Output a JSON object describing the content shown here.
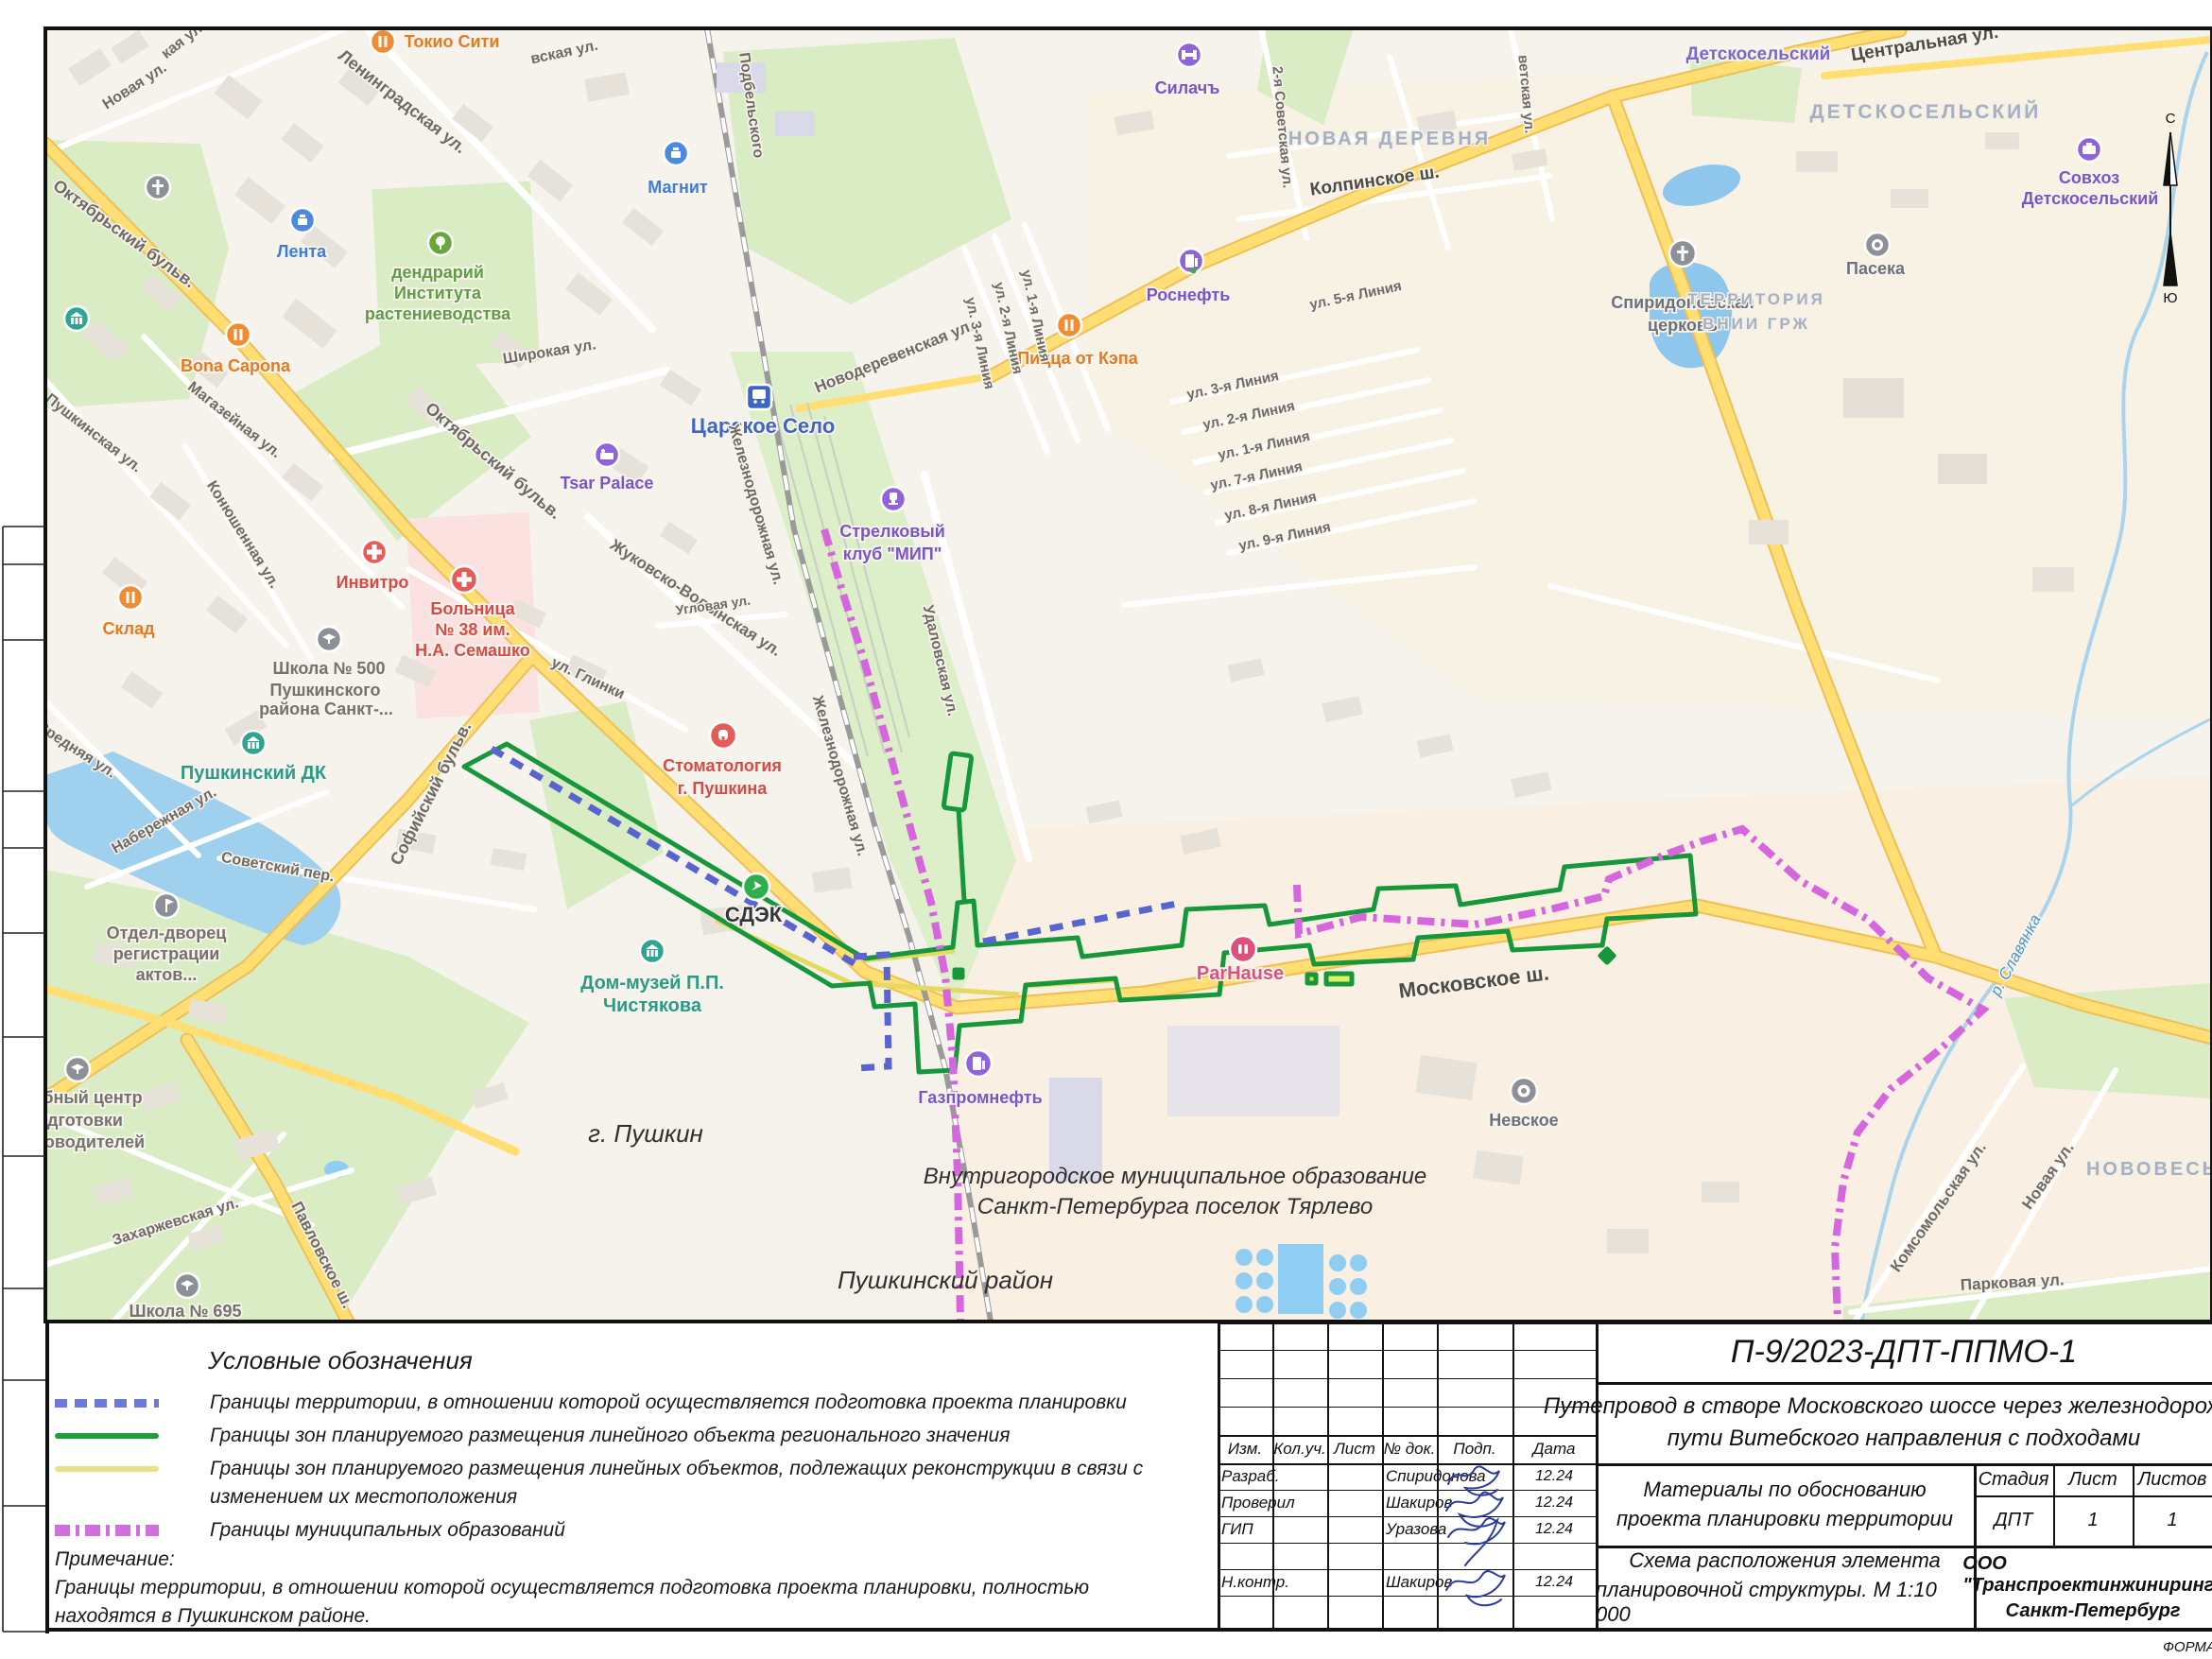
{
  "map": {
    "streets": {
      "novaya": "Новая ул.",
      "kaya": "кая ул.",
      "leningradskaya": "Ленинградская ул.",
      "oktyabrsky": "Октябрьский бульв.",
      "shirokaya": "Широкая ул.",
      "magazeynaya": "Магазейная ул.",
      "pushkinskaya": "Пушкинская ул.",
      "konyushennaya": "Конюшенная ул.",
      "zhukovsko": "Жуковско-Волынская ул.",
      "glinki": "ул. Глинки",
      "sofiysky": "Софийский бульв.",
      "srednyaya": "Средняя ул.",
      "naberezhnaya": "Набережная ул.",
      "sovetsky_per": "Советский пер.",
      "zaharzhevskaya": "Захаржевская ул.",
      "pavlovskoe": "Павловское ш.",
      "zheleznodorozhnaya": "Железнодорожная ул.",
      "novoderevenskaya": "Новодеревенская ул.",
      "udalovskaya": "Удаловская ул.",
      "uglovaya": "Угловая ул.",
      "kolpinskoe": "Колпинское ш.",
      "sovetskaya2": "2-я Советская ул.",
      "vetskaya": "ветская ул.",
      "line5": "ул. 5-я Линия",
      "line3": "ул. 3-я Линия",
      "line2": "ул. 2-я Линия",
      "line1": "ул. 1-я Линия",
      "line7": "ул. 7-я Линия",
      "line8": "ул. 8-я Линия",
      "line9": "ул. 9-я Линия",
      "tsentralnaya": "Центральная ул.",
      "podbelskogo": "Подбельского",
      "vskaya": "вская ул.",
      "komsomolskaya": "Комсомольская ул.",
      "parkovaya": "Парковая ул.",
      "moskovskoe": "Московское ш."
    },
    "districts": {
      "novaya_derevnya": "НОВАЯ ДЕРЕВНЯ",
      "detskoselsky_big": "ДЕТСКОСЕЛЬСКИЙ",
      "territoria": "ТЕРРИТОРИЯ",
      "vnii": "ВНИИ ГРЖ",
      "novoves": "НОВОВЕСЬ"
    },
    "towns": {
      "detskoselsky": "Детскосельский"
    },
    "areas": {
      "pushkin": "г. Пушкин",
      "pushkinsky_rayon": "Пушкинский район",
      "mo_line1": "Внутригородское муниципальное образование",
      "mo_line2": "Санкт-Петербурга поселок Тярлево"
    },
    "water": {
      "slavyanka": "р. Славянка"
    },
    "compass": {
      "n": "С",
      "s": "Ю"
    },
    "pois": {
      "tokyo": "Токио Сити",
      "lenta": "Лента",
      "magnit": "Магнит",
      "dendr": [
        "дендрарий",
        "Института",
        "растениеводства"
      ],
      "bona": "Bona Capona",
      "station": "Царское Село",
      "pizza": "Пицца от Кэпа",
      "rosneft": "Роснефть",
      "silach": "Силачъ",
      "spirid": [
        "Спиридоновская",
        "церковь"
      ],
      "paseka": "Пасека",
      "sovhoz": [
        "Совхоз",
        "Детскосельский"
      ],
      "tsar": "Tsar Palace",
      "invitro": "Инвитро",
      "hospital": [
        "Больница",
        "№ 38 им.",
        "Н.А. Семашко"
      ],
      "sklad": "Склад",
      "school500": [
        "Школа № 500",
        "Пушкинского",
        "района Санкт-..."
      ],
      "dk": "Пушкинский ДК",
      "zags": [
        "Отдел-дворец",
        "регистрации",
        "актов..."
      ],
      "stomat": [
        "Стоматология",
        "г. Пушкина"
      ],
      "cdek": "СДЭК",
      "chist": [
        "Дом-музей П.П.",
        "Чистякова"
      ],
      "club": [
        "Стрелковый",
        "клуб \"МИП\""
      ],
      "gazprom": "Газпромнефть",
      "nevskoe": "Невское",
      "training": [
        "бный центр",
        "дготовки",
        "оводителей"
      ],
      "school695": "Школа № 695",
      "parhause": "ParHause"
    }
  },
  "legend": {
    "title": "Условные обозначения",
    "items": {
      "territory": {
        "lines": [
          "Границы территории, в отношении которой осуществляется подготовка проекта планировки"
        ]
      },
      "regional": {
        "lines": [
          "Границы зон планируемого размещения линейного объекта регионального значения"
        ]
      },
      "reconstruction": {
        "lines": [
          "Границы зон планируемого размещения линейных объектов, подлежащих реконструкции в связи с",
          "изменением их местоположения"
        ]
      },
      "municipal": {
        "lines": [
          "Границы муниципальных образований"
        ]
      }
    },
    "note_title": "Примечание:",
    "note_lines": [
      "Границы территории, в отношении которой осуществляется подготовка проекта планировки, полностью",
      "находятся в Пушкинском районе."
    ],
    "colors": {
      "territory": "#6b79d8",
      "regional": "#1f9e3c",
      "reconstruction": "#e6e387",
      "municipal": "#d36ede"
    }
  },
  "title_block": {
    "doc_number": "П-9/2023-ДПТ-ППМО-1",
    "object_lines": [
      "Путепровод в створе Московского шоссе через железнодорожные",
      "пути Витебского направления с подходами"
    ],
    "materials_lines": [
      "Материалы по обоснованию",
      "проекта планировки территории"
    ],
    "scheme_lines": [
      "Схема расположения элемента",
      "планировочной структуры. М 1:10 000"
    ],
    "company_lines": [
      "ООО \"Транспроектинжиниринг\"",
      "Санкт-Петербург"
    ],
    "columns": [
      "Изм.",
      "Кол.уч.",
      "Лист",
      "№ док.",
      "Подп.",
      "Дата"
    ],
    "stage_cols": [
      "Стадия",
      "Лист",
      "Листов"
    ],
    "stage_values": [
      "ДПТ",
      "1",
      "1"
    ],
    "rows": [
      {
        "role": "Разраб.",
        "name": "Спиридонова",
        "date": "12.24"
      },
      {
        "role": "Проверил",
        "name": "Шакиров",
        "date": "12.24"
      },
      {
        "role": "ГИП",
        "name": "Уразова",
        "date": "12.24"
      },
      {
        "role": "",
        "name": "",
        "date": ""
      },
      {
        "role": "Н.контр.",
        "name": "Шакиров",
        "date": "12.24"
      }
    ],
    "form_note": "ФОРМА"
  }
}
